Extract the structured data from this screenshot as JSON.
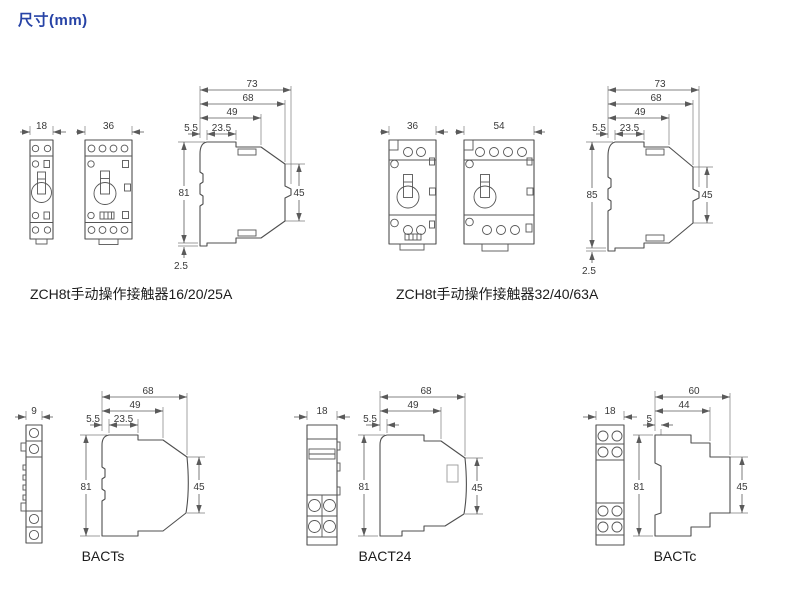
{
  "title": "尺寸(mm)",
  "colors": {
    "title_blue": "#2743a6",
    "line_gray": "#4f4f4f"
  },
  "groups": {
    "zch8t_small": {
      "caption": "ZCH8t手动操作接触器16/20/25A",
      "front1_width": "18",
      "front2_width": "36",
      "side": {
        "d73": "73",
        "d68": "68",
        "d49": "49",
        "d5_5": "5.5",
        "d23_5": "23.5",
        "h": "81",
        "back": "45",
        "foot": "2.5"
      }
    },
    "zch8t_large": {
      "caption": "ZCH8t手动操作接触器32/40/63A",
      "front1_width": "36",
      "front2_width": "54",
      "side": {
        "d73": "73",
        "d68": "68",
        "d49": "49",
        "d5_5": "5.5",
        "d23_5": "23.5",
        "h": "85",
        "back": "45",
        "foot": "2.5"
      }
    },
    "bacts": {
      "caption": "BACTs",
      "front_width": "9",
      "side": {
        "d68": "68",
        "d49": "49",
        "d5_5": "5.5",
        "d23_5": "23.5",
        "h": "81",
        "back": "45"
      }
    },
    "bact24": {
      "caption": "BACT24",
      "front_width": "18",
      "side": {
        "d68": "68",
        "d49": "49",
        "d5_5": "5.5",
        "h": "81",
        "back": "45"
      }
    },
    "bactc": {
      "caption": "BACTc",
      "front_width": "18",
      "side": {
        "d60": "60",
        "d44": "44",
        "d5": "5",
        "h": "81",
        "back": "45"
      }
    }
  }
}
